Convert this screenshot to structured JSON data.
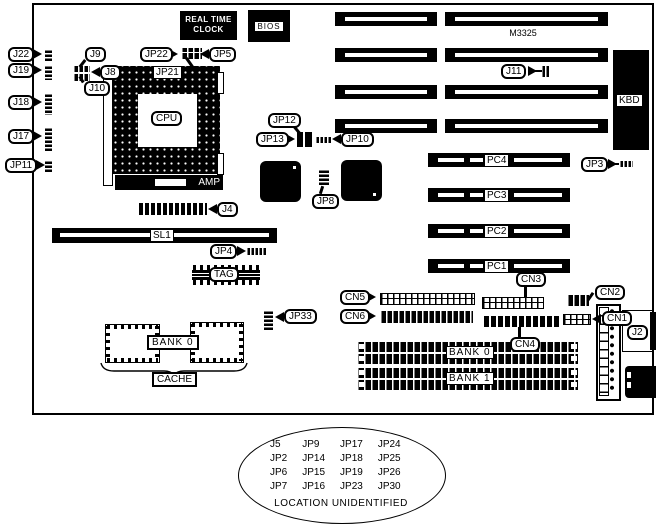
{
  "board_marking": "M3325",
  "blocks": {
    "rtc_line1": "REAL TIME",
    "rtc_line2": "CLOCK",
    "bios": "BIOS",
    "kbd": "KBD",
    "amp": "AMP",
    "cpu": "CPU"
  },
  "labels": {
    "j22": "J22",
    "j19": "J19",
    "j18": "J18",
    "j17": "J17",
    "jp11": "JP11",
    "j9": "J9",
    "j8": "J8",
    "j10": "J10",
    "jp22": "JP22",
    "jp5": "JP5",
    "jp21": "JP21",
    "jp12": "JP12",
    "jp13": "JP13",
    "jp10": "JP10",
    "jp8": "JP8",
    "j11": "J11",
    "jp3": "JP3",
    "j4": "J4",
    "sl1": "SL1",
    "jp4": "JP4",
    "tag": "TAG",
    "jp33": "JP33",
    "cache_bank": "BANK 0",
    "cache": "CACHE",
    "cn5": "CN5",
    "cn6": "CN6",
    "cn3": "CN3",
    "cn4": "CN4",
    "cn2": "CN2",
    "cn1": "CN1",
    "j2": "J2",
    "pc4": "PC4",
    "pc3": "PC3",
    "pc2": "PC2",
    "pc1": "PC1",
    "bank0": "BANK 0",
    "bank1": "BANK 1"
  },
  "legend": {
    "rows": [
      [
        "J5",
        "JP9",
        "JP17",
        "JP24"
      ],
      [
        "JP2",
        "JP14",
        "JP18",
        "JP25"
      ],
      [
        "JP6",
        "JP15",
        "JP19",
        "JP26"
      ],
      [
        "JP7",
        "JP16",
        "JP23",
        "JP30"
      ]
    ],
    "caption": "LOCATION UNIDENTIFIED"
  },
  "colors": {
    "ink": "#000000",
    "paper": "#ffffff"
  }
}
